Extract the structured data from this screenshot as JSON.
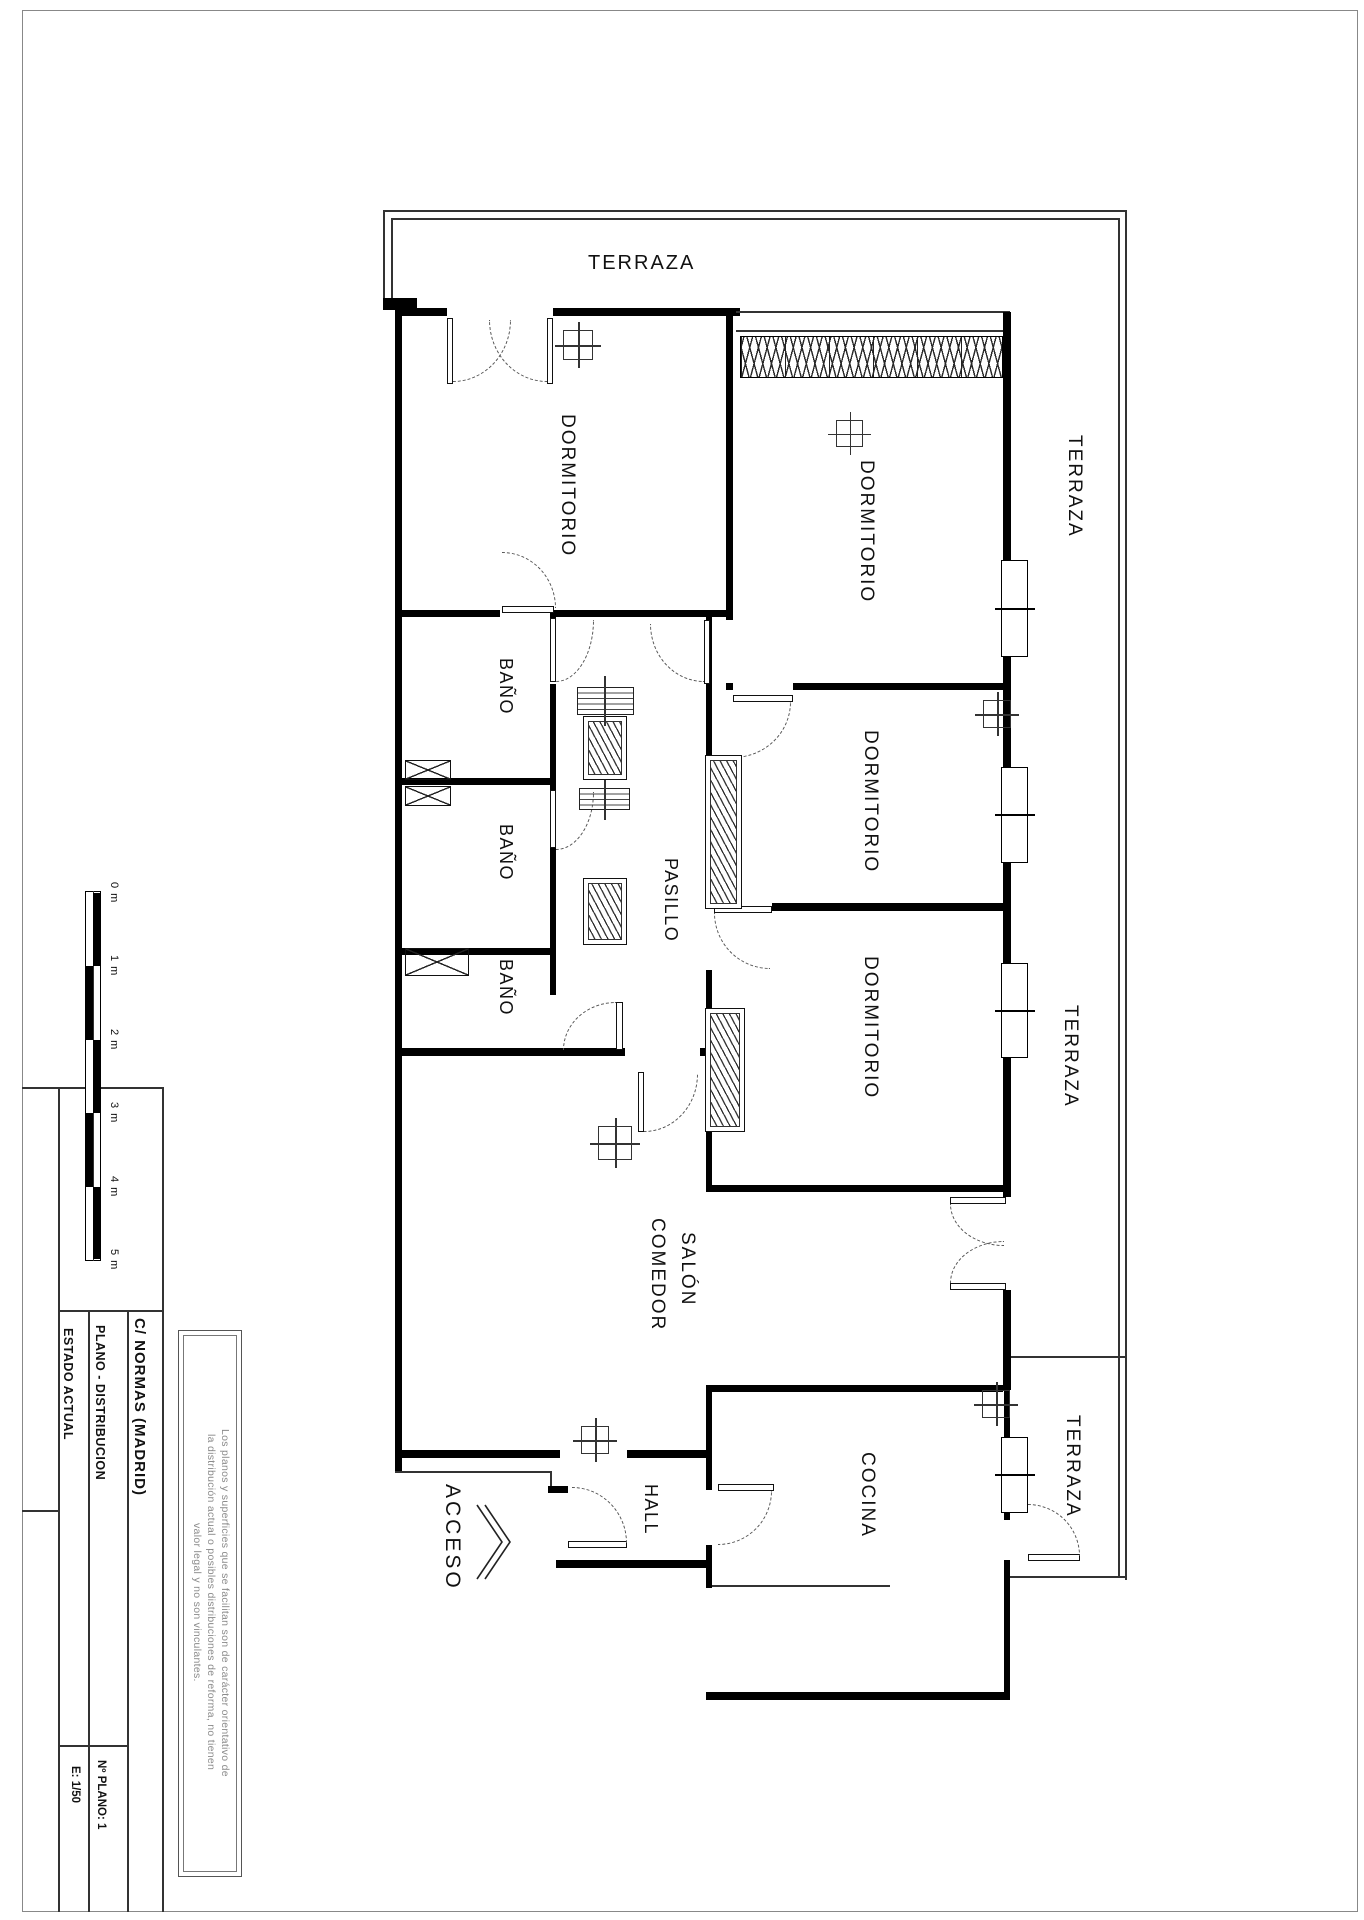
{
  "sheet": {
    "project": "C/ NORMAS  (MADRID)",
    "plan_type": "PLANO  -  DISTRIBUCION",
    "state": "ESTADO ACTUAL",
    "plan_number": "Nº PLANO: 1",
    "scale": "E: 1/50",
    "disclaimer_line1": "Los planos y superficies que se facilitan son de carácter orientativo de",
    "disclaimer_line2": "la distribución actual o posibles distribuciones de reforma, no tienen",
    "disclaimer_line3": "valor legal y no son vinculantes."
  },
  "scale_bar": {
    "labels": [
      "0 m",
      "1 m",
      "2 m",
      "3 m",
      "4 m",
      "5 m"
    ]
  },
  "rooms": {
    "terraza_top": "TERRAZA",
    "terraza_right_upper": "TERRAZA",
    "terraza_right_middle": "TERRAZA",
    "terraza_right_lower": "TERRAZA",
    "dormitorio1": "DORMITORIO",
    "dormitorio2": "DORMITORIO",
    "dormitorio3": "DORMITORIO",
    "dormitorio4": "DORMITORIO",
    "bano1": "BAÑO",
    "bano2": "BAÑO",
    "bano3": "BAÑO",
    "pasillo": "PASILLO",
    "salon_line1": "SALÓN",
    "salon_line2": "COMEDOR",
    "hall": "HALL",
    "cocina": "COCINA",
    "acceso": "ACCESO"
  },
  "colors": {
    "wall": "#000000",
    "line": "#333333",
    "muted_text": "#8a8a8a"
  }
}
